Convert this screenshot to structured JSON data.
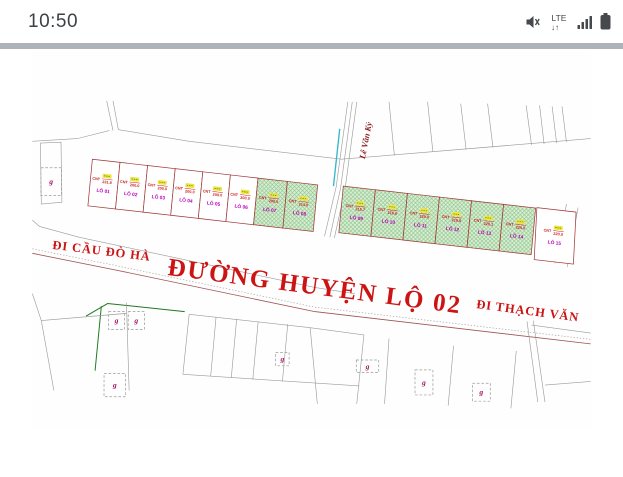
{
  "status_bar": {
    "time": "10:50",
    "network_label": "LTE",
    "network_arrows": "↓↑"
  },
  "map": {
    "road_main_label": "ĐƯỜNG HUYỆN LỘ 02",
    "direction_left_label": "ĐI CẦU ĐÒ HÀ",
    "direction_right_label": "ĐI THẠCH VĂN",
    "street_label": "Lê Văn Kỷ",
    "grave_symbol": "g",
    "plots": [
      {
        "id": "LÔ 01",
        "zone": "CNT",
        "area": "231.9",
        "highlighted": false
      },
      {
        "id": "LÔ 02",
        "zone": "CNT",
        "area": "200.0",
        "highlighted": false
      },
      {
        "id": "LÔ 03",
        "zone": "CNT",
        "area": "200.0",
        "highlighted": false
      },
      {
        "id": "LÔ 04",
        "zone": "CNT",
        "area": "200.0",
        "highlighted": false
      },
      {
        "id": "LÔ 05",
        "zone": "CNT",
        "area": "200.0",
        "highlighted": false
      },
      {
        "id": "LÔ 06",
        "zone": "CNT",
        "area": "200.0",
        "highlighted": false
      },
      {
        "id": "LÔ 07",
        "zone": "CNT",
        "area": "200.0",
        "highlighted": true
      },
      {
        "id": "LÔ 08",
        "zone": "CNT",
        "area": "214.0",
        "highlighted": true
      },
      {
        "id": "LÔ 09",
        "zone": "CNT",
        "area": "215.7",
        "highlighted": true
      },
      {
        "id": "LÔ 10",
        "zone": "CNT",
        "area": "216.6",
        "highlighted": true
      },
      {
        "id": "LÔ 11",
        "zone": "CNT",
        "area": "220.0",
        "highlighted": true
      },
      {
        "id": "LÔ 12",
        "zone": "CNT",
        "area": "219.9",
        "highlighted": true
      },
      {
        "id": "LÔ 13",
        "zone": "CNT",
        "area": "220.1",
        "highlighted": true
      },
      {
        "id": "LÔ 14",
        "zone": "CNT",
        "area": "220.0",
        "highlighted": true
      },
      {
        "id": "LÔ 15",
        "zone": "CNT",
        "area": "220.0",
        "highlighted": false
      }
    ],
    "colors": {
      "highlight_fill": "#d9eed3",
      "hatch_line": "#84bf84",
      "boundary": "#a03434",
      "road_text": "#cc1414",
      "lot_label": "#bb00bb",
      "area_text": "#cc2020",
      "street_text": "#8b1a1a",
      "grave_text": "#a01060",
      "highlight_mark": "#f0e33c"
    }
  }
}
